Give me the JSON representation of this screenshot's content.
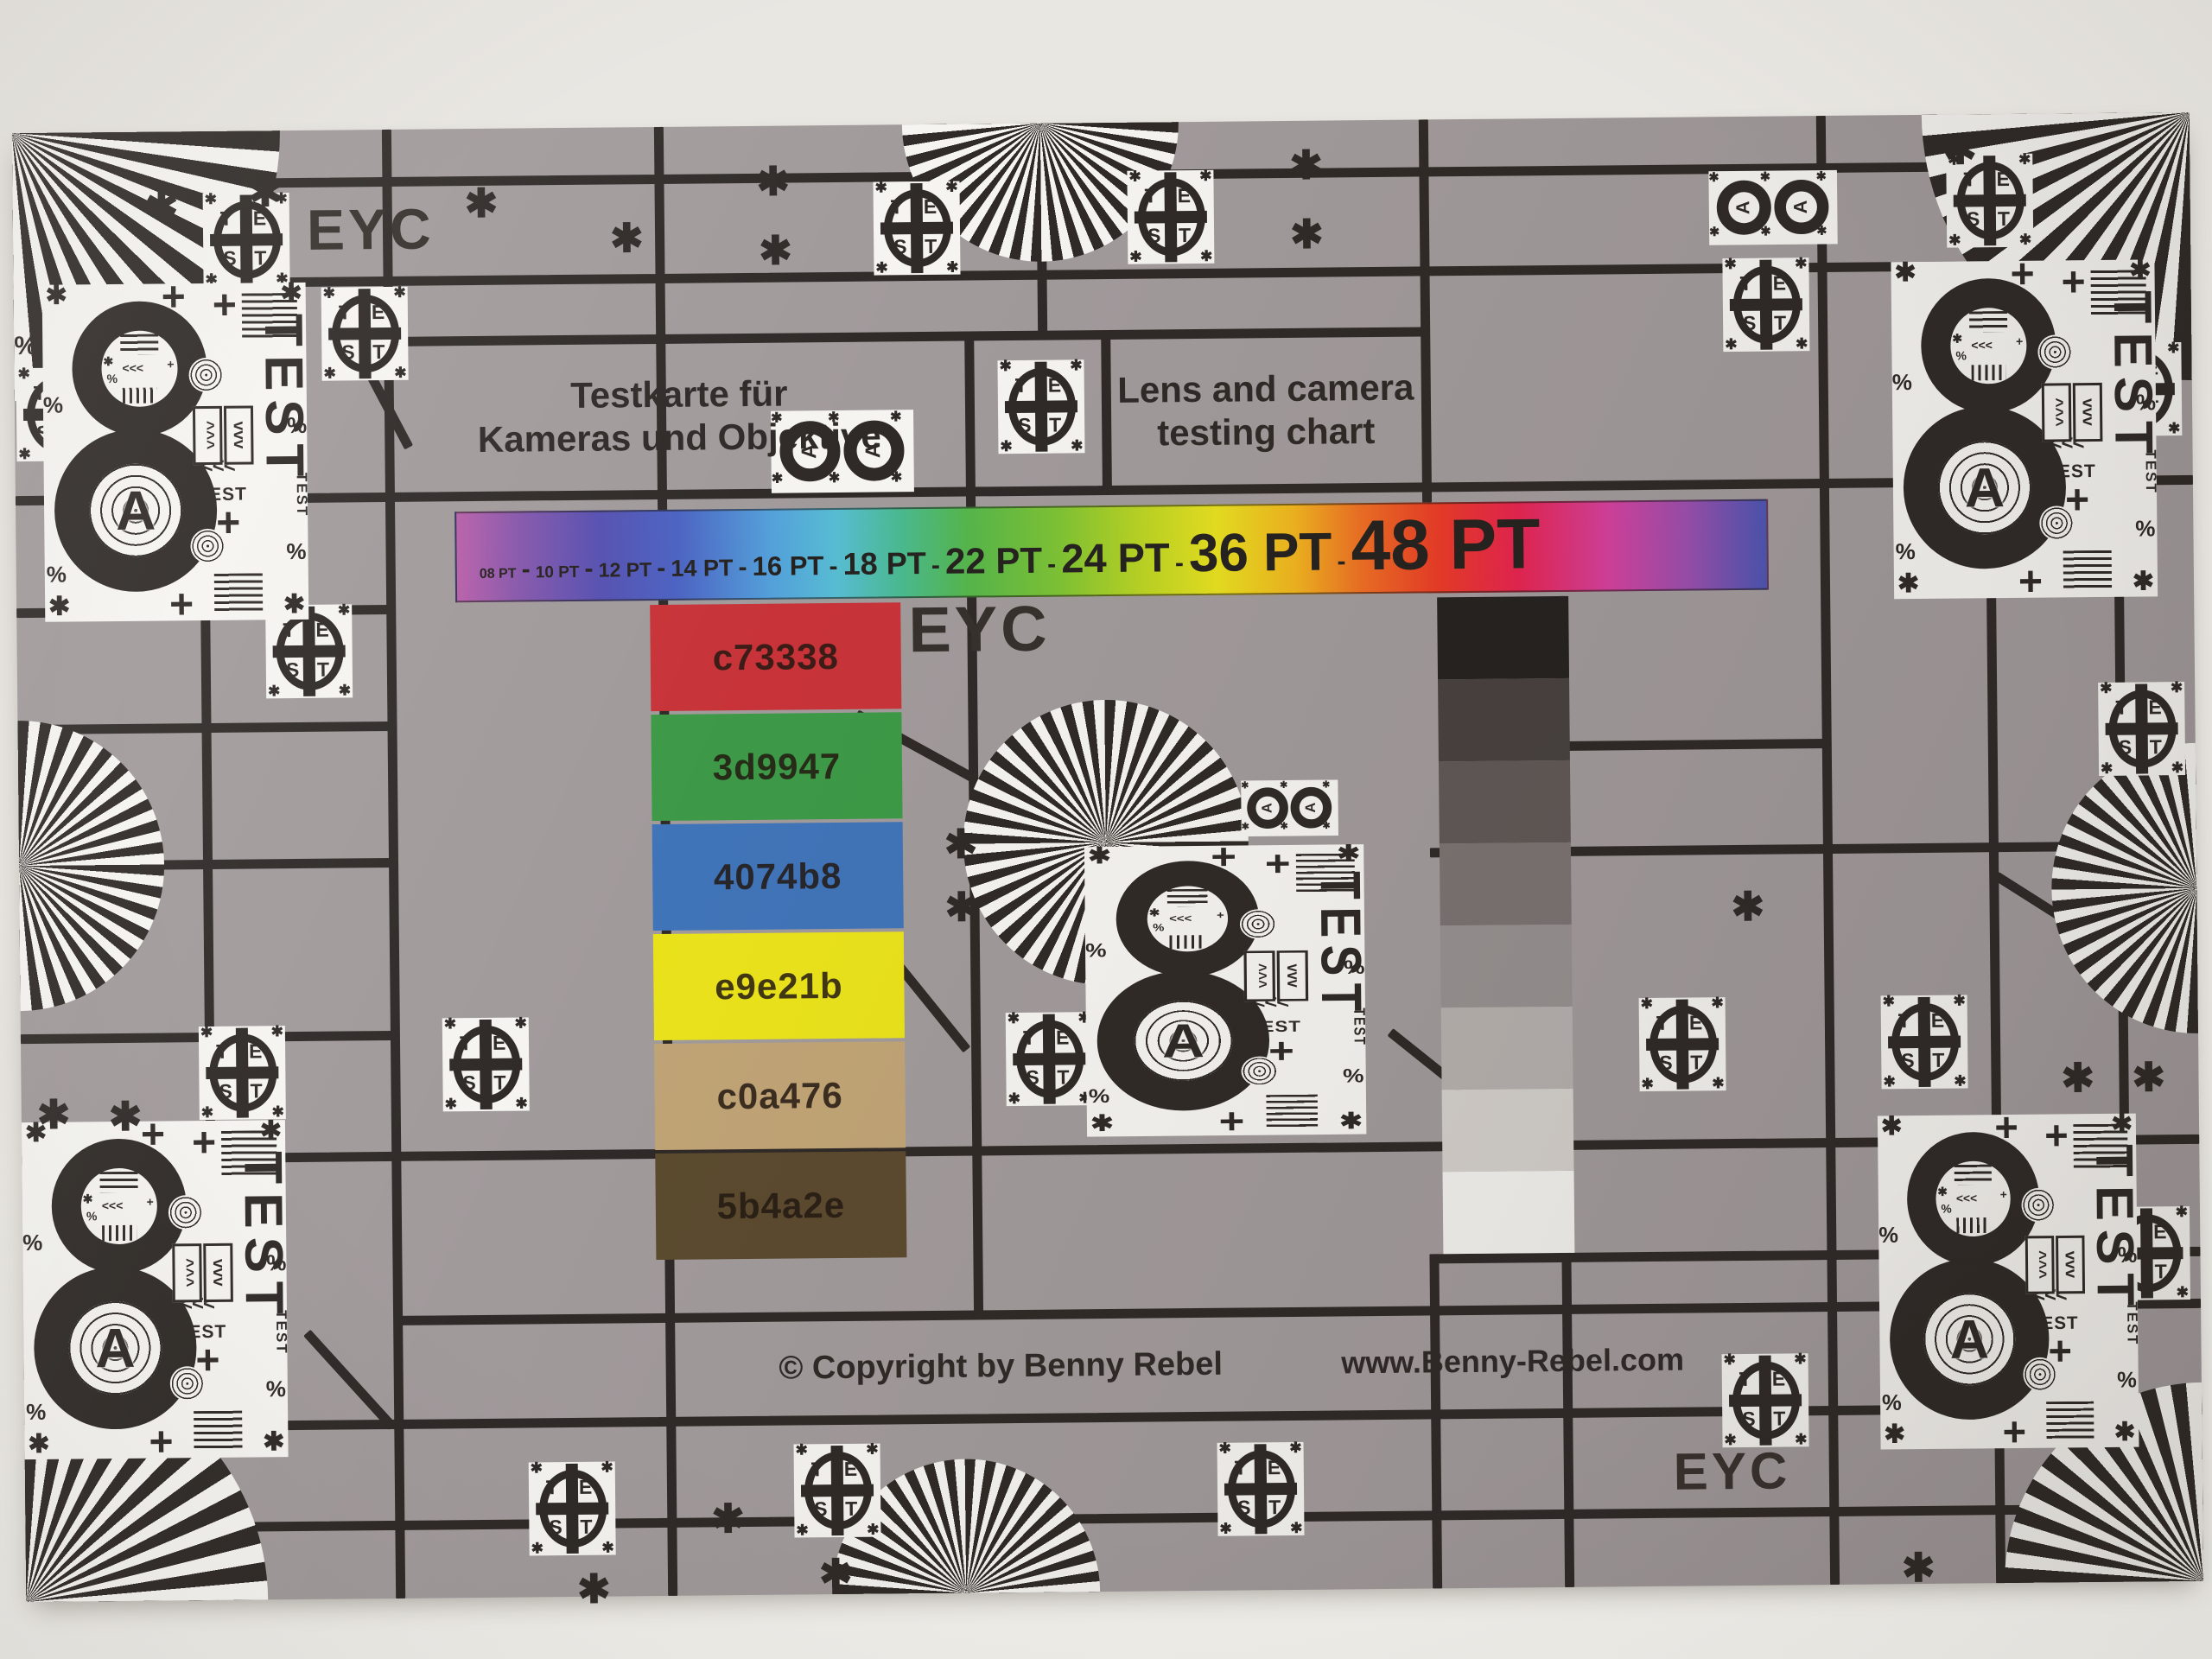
{
  "photo": {
    "background_top": "#e9e7e2",
    "background_bottom": "#efeee9"
  },
  "chart": {
    "surface_color": "#a19a9b",
    "ink_color": "#2f2a27",
    "paper_white": "#f5f4f0",
    "rotation_deg": -0.55
  },
  "texts": {
    "eyc": "EYC",
    "title_de_line1": "Testkarte für",
    "title_de_line2": "Kameras und Objektive",
    "title_en_line1": "Lens and camera",
    "title_en_line2": "testing chart",
    "copyright": "© Copyright by Benny Rebel",
    "website": "www.Benny-Rebel.com"
  },
  "font_scale_bar": {
    "labels": [
      "08 PT",
      "10 PT",
      "12 PT",
      "14 PT",
      "16 PT",
      "18 PT",
      "22 PT",
      "24 PT",
      "36 PT",
      "48 PT"
    ],
    "separator": "-",
    "gradient_stops": [
      {
        "color": "#b85fa8",
        "pos": 0
      },
      {
        "color": "#8356ab",
        "pos": 5
      },
      {
        "color": "#5550b0",
        "pos": 11
      },
      {
        "color": "#4b63c2",
        "pos": 17
      },
      {
        "color": "#53a0da",
        "pos": 24
      },
      {
        "color": "#57bcd2",
        "pos": 29
      },
      {
        "color": "#4ab98e",
        "pos": 34
      },
      {
        "color": "#55b54b",
        "pos": 39
      },
      {
        "color": "#7ec234",
        "pos": 46
      },
      {
        "color": "#b7d224",
        "pos": 52
      },
      {
        "color": "#e6df20",
        "pos": 58
      },
      {
        "color": "#efb31f",
        "pos": 64
      },
      {
        "color": "#ed6f24",
        "pos": 69
      },
      {
        "color": "#e93b27",
        "pos": 75
      },
      {
        "color": "#e62450",
        "pos": 81
      },
      {
        "color": "#d4419e",
        "pos": 88
      },
      {
        "color": "#9a4fae",
        "pos": 94
      },
      {
        "color": "#4c55b2",
        "pos": 100
      }
    ]
  },
  "color_patches": [
    {
      "label": "c73338",
      "color": "#c73338"
    },
    {
      "label": "3d9947",
      "color": "#3d9947"
    },
    {
      "label": "4074b8",
      "color": "#4074b8"
    },
    {
      "label": "e9e21b",
      "color": "#e9e21b"
    },
    {
      "label": "c0a476",
      "color": "#c0a476"
    },
    {
      "label": "5b4a2e",
      "color": "#5b4a2e"
    }
  ],
  "grayscale_steps": [
    "#262220",
    "#474140",
    "#5f5856",
    "#7a7371",
    "#969090",
    "#b5b0ad",
    "#d3cfcb",
    "#f2f1ed"
  ],
  "test_marker": {
    "letters": [
      "T",
      "E",
      "S",
      "T"
    ],
    "corner_glyph": "✱"
  },
  "focus_target": {
    "digit": "8",
    "letter": "A",
    "label_large": "TEST",
    "label_small": "TEST",
    "percent": "%",
    "plus": "+",
    "asterisk": "✱",
    "chevrons_left": "<<<",
    "chevrons_up": "^^^",
    "chevrons_down": "vvv"
  },
  "decor": {
    "asterisk_glyph": "✱",
    "percent_glyph": "%"
  }
}
